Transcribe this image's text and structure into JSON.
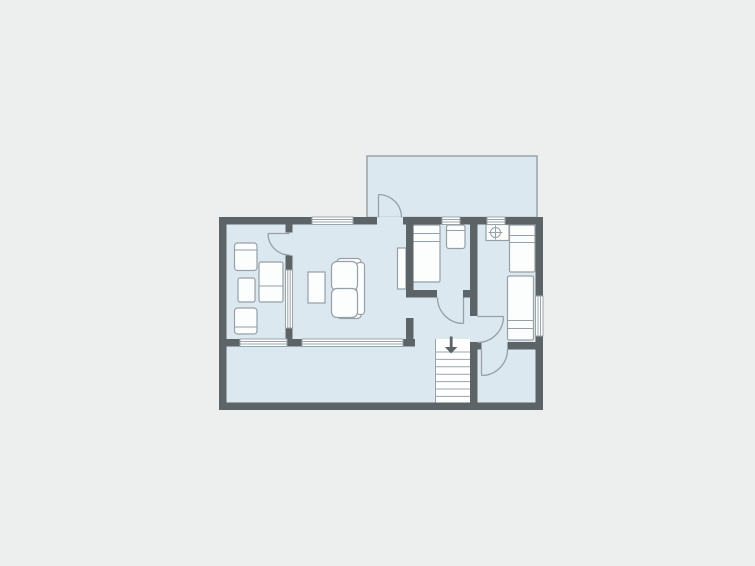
{
  "canvas": {
    "width": 755,
    "height": 566
  },
  "colors": {
    "background": "#edefee",
    "floor": "#dce8f0",
    "wall": "#5d6468",
    "outline": "#96a0a6",
    "thin_outline": "#9aa4ab",
    "furniture_fill": "#fcfdfd",
    "stairs_fill": "#ffffff"
  },
  "floorplan": {
    "type": "apartment-floor-plan",
    "rooms": [
      {
        "name": "upper-terrace"
      },
      {
        "name": "sitting-room"
      },
      {
        "name": "living-room"
      },
      {
        "name": "bedroom"
      },
      {
        "name": "right-bedroom"
      },
      {
        "name": "hallway"
      },
      {
        "name": "lower-room"
      },
      {
        "name": "lower-terrace"
      }
    ],
    "furniture": {
      "armchairs": 2,
      "side_tables": 2,
      "square_table": 1,
      "sofa_seats": 2,
      "coffee_table": 1,
      "shelf": 1,
      "single_beds": 3,
      "nightstand": 1,
      "washbasin": 1
    },
    "windows": 7,
    "doors": 5,
    "stairs": {
      "treads": 7,
      "direction_arrow": "down"
    }
  }
}
